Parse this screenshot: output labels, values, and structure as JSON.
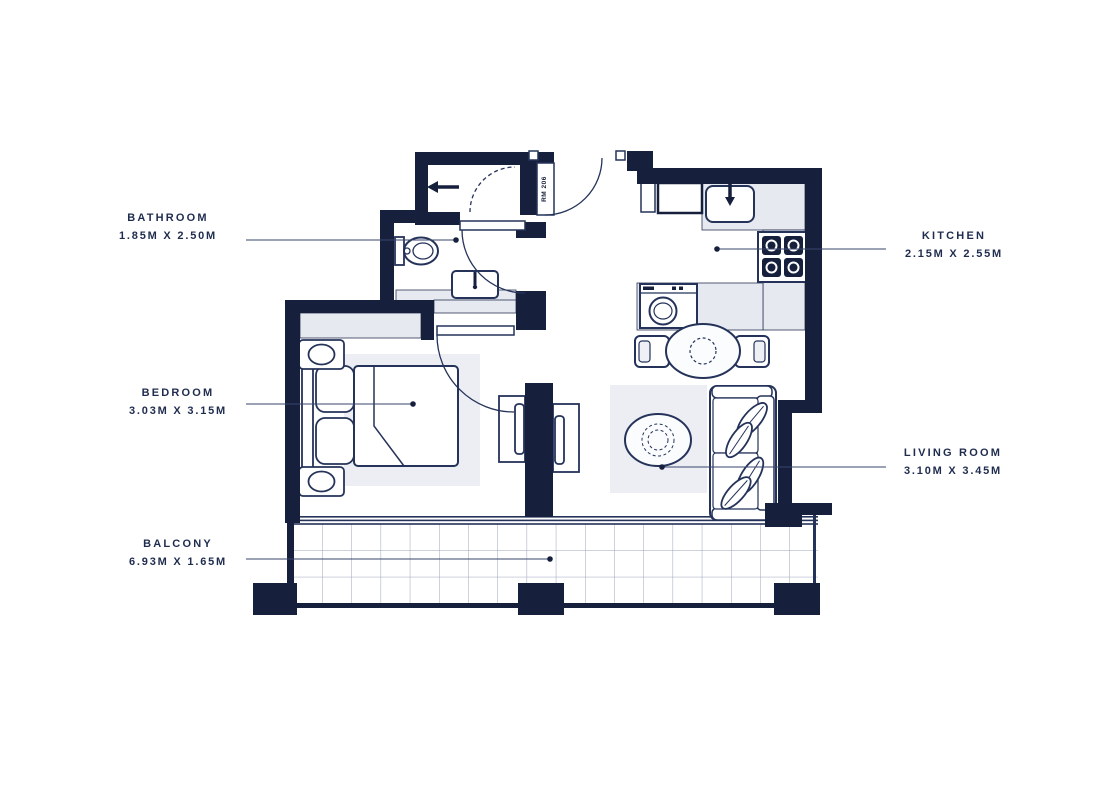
{
  "plan": {
    "unit_door_label": "RM 206",
    "rooms": [
      {
        "name": "BATHROOM",
        "dimensions": "1.85M X 2.50M"
      },
      {
        "name": "KITCHEN",
        "dimensions": "2.15M X 2.55M"
      },
      {
        "name": "BEDROOM",
        "dimensions": "3.03M X 3.15M"
      },
      {
        "name": "LIVING ROOM",
        "dimensions": "3.10M X 3.45M"
      },
      {
        "name": "BALCONY",
        "dimensions": "6.93M X 1.65M"
      }
    ],
    "colors": {
      "wall": "#16203d",
      "line": "#25335a",
      "counter": "#e7e9f0",
      "rug": "#eceef4",
      "tile_grid": "#9aa4bc",
      "text": "#1f2c4e"
    }
  }
}
